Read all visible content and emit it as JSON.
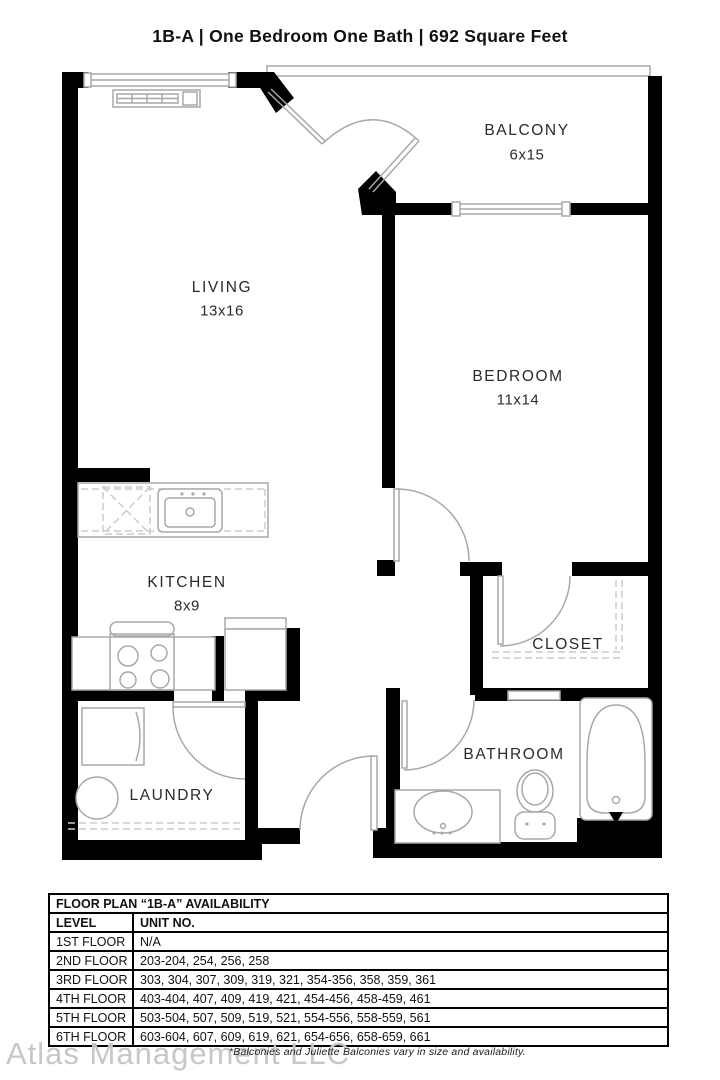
{
  "title": "1B-A | One Bedroom One Bath |  692 Square Feet",
  "floor_plan": {
    "rooms": [
      {
        "id": "balcony",
        "label": "BALCONY",
        "dims": "6x15"
      },
      {
        "id": "living",
        "label": "LIVING",
        "dims": "13x16"
      },
      {
        "id": "bedroom",
        "label": "BEDROOM",
        "dims": "11x14"
      },
      {
        "id": "kitchen",
        "label": "KITCHEN",
        "dims": "8x9"
      },
      {
        "id": "closet",
        "label": "CLOSET",
        "dims": ""
      },
      {
        "id": "bathroom",
        "label": "BATHROOM",
        "dims": ""
      },
      {
        "id": "laundry",
        "label": "LAUNDRY",
        "dims": ""
      }
    ]
  },
  "availability_table": {
    "title": "FLOOR PLAN “1B-A” AVAILABILITY",
    "columns": [
      "LEVEL",
      "UNIT NO."
    ],
    "rows": [
      [
        "1ST FLOOR",
        "N/A"
      ],
      [
        "2ND FLOOR",
        "203-204, 254, 256, 258"
      ],
      [
        "3RD FLOOR",
        "303, 304, 307, 309, 319, 321, 354-356, 358, 359, 361"
      ],
      [
        "4TH FLOOR",
        "403-404, 407, 409, 419, 421, 454-456, 458-459, 461"
      ],
      [
        "5TH FLOOR",
        "503-504, 507, 509, 519, 521, 554-556, 558-559, 561"
      ],
      [
        "6TH FLOOR",
        "603-604, 607, 609, 619, 621, 654-656, 658-659, 661"
      ]
    ]
  },
  "footer": {
    "watermark": "Atlas Management LLC",
    "note": "*Balconies and Juliette Balconies vary in size and availability."
  },
  "colors": {
    "wall": "#000000",
    "fixture_line": "#a8a8a8",
    "dashed_line": "#cccccc",
    "background": "#ffffff",
    "watermark": "#c7c7c7"
  }
}
